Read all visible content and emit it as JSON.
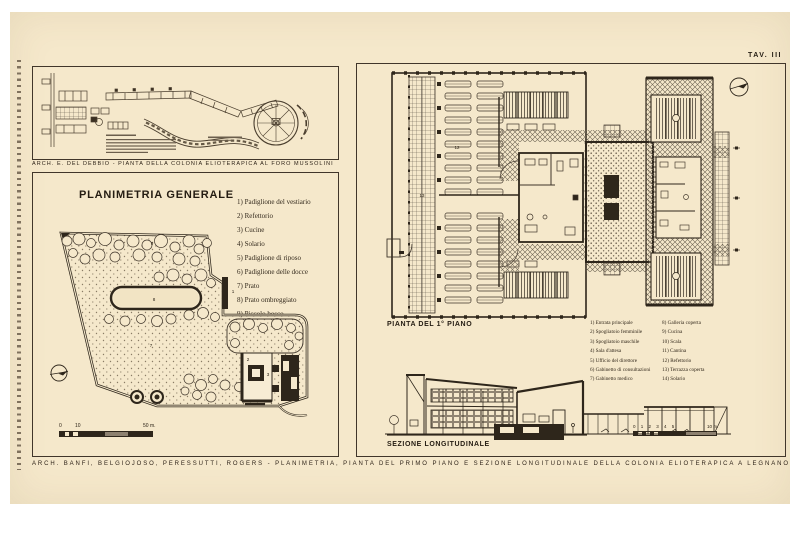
{
  "page": {
    "tav_label": "TAV. III"
  },
  "del_debbio": {
    "caption": "ARCH. E. DEL DEBBIO - PIANTA DELLA COLONIA ELIOTERAPICA AL FORO MUSSOLINI"
  },
  "planimetria": {
    "title": "PLANIMETRIA GENERALE",
    "legend": [
      "1) Padiglione del vestiario",
      "2) Refettorio",
      "3) Cucine",
      "4) Solario",
      "5) Padiglione di riposo",
      "6) Padiglione delle docce",
      "7) Prato",
      "8) Prato ombreggiato",
      "9) Piccolo bosco"
    ],
    "plan_numbers": {
      "vestiario": "1",
      "refettorio": "2",
      "cucine": "3",
      "prato": "7",
      "prato_ombreggiato": "8",
      "piccolo_bosco": "9"
    },
    "scale": {
      "zero": "0",
      "ten": "10",
      "fifty": "50 m."
    }
  },
  "pianta": {
    "title": "PIANTA DEL 1° PIANO",
    "legend_col1": [
      "1) Entrata principale",
      "2) Spogliatoio femminile",
      "3) Spogliatoio maschile",
      "4) Sala d'attesa",
      "5) Ufficio del direttore",
      "6) Gabinetto di consultazioni",
      "7) Gabinetto medico"
    ],
    "legend_col2": [
      "8) Galleria coperta",
      "9) Cucina",
      "10) Scala",
      "11) Cantina",
      "12) Refettorio",
      "13) Terrazza coperta",
      "14) Solario"
    ],
    "plan_numbers": {
      "refettorio": "12",
      "terrazza_coperta": "13"
    }
  },
  "sezione": {
    "title": "SEZIONE LONGITUDINALE",
    "scale": {
      "ticks": "0 1 2 3 4 5",
      "end": "10 m."
    }
  },
  "footer": {
    "caption": "ARCH. BANFI, BELGIOJOSO, PERESSUTTI, ROGERS - PLANIMETRIA, PIANTA DEL PRIMO PIANO E SEZIONE LONGITUDINALE DELLA COLONIA ELIOTERAPICA A LEGNANO"
  }
}
